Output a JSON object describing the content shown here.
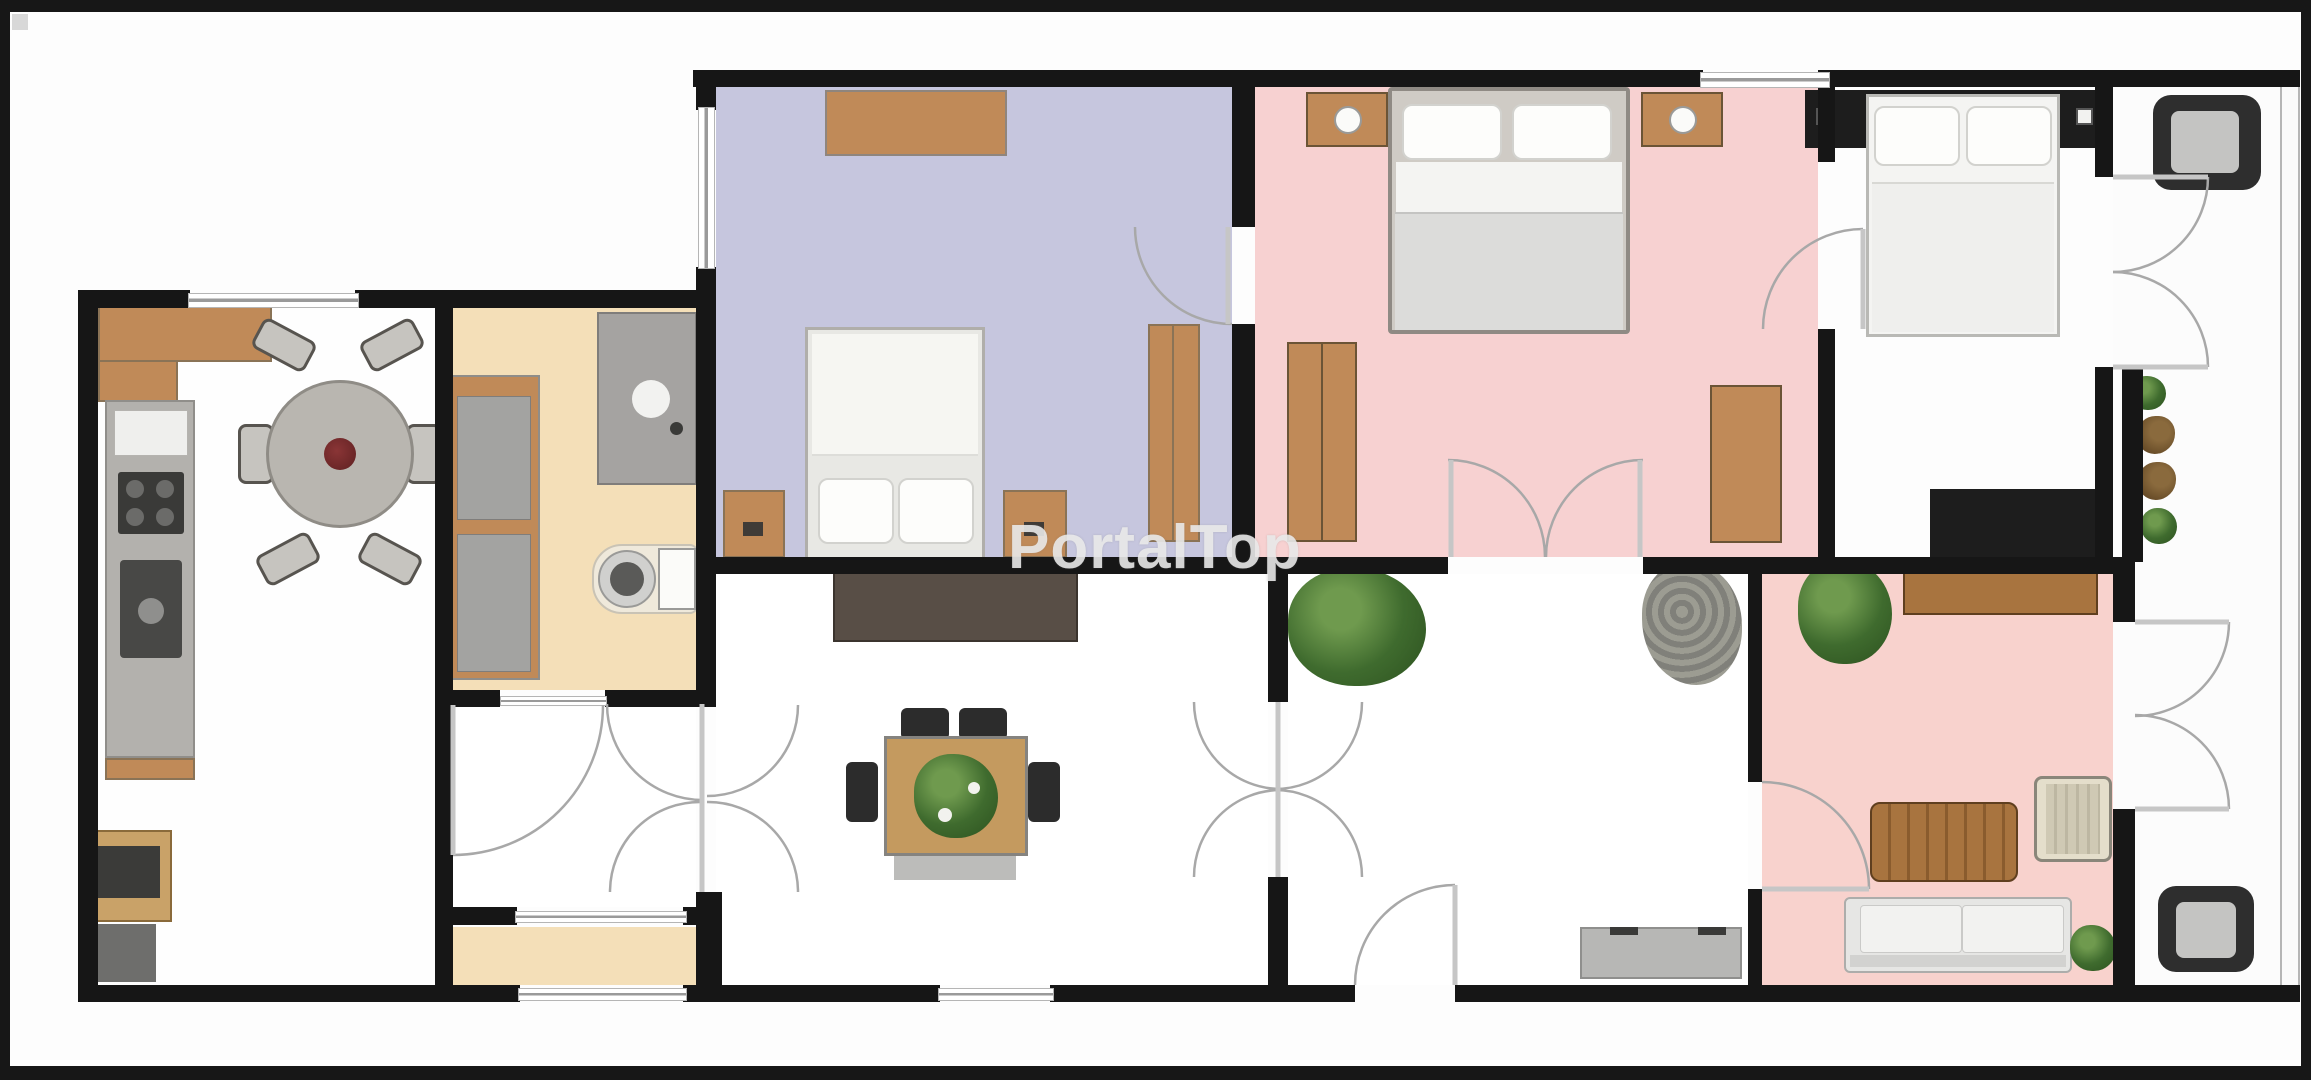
{
  "watermark": {
    "text": "PortalTop"
  },
  "palette": {
    "wall": "#161616",
    "frame": "#171717",
    "window_line": "#9a9a9a",
    "door_arc": "#a8a8a8",
    "floor_white": "#ffffff",
    "floor_lavender": "#c6c6de",
    "floor_pink_bedroom": "#f7d1d1",
    "floor_pink_living": "#f8d2cd",
    "floor_cream": "#f4dfb8",
    "wood_light": "#c08a58",
    "wood_dark": "#a8743f",
    "counter_gray": "#b3b1ad",
    "sideboard_brown": "#584e46",
    "chair_black": "#2c2c2c",
    "rug_gray": "#bcbcba",
    "sofa_gray": "#e6e6e4",
    "plant_green": "#3f6b2e",
    "shrub_gray": "#8d8d83",
    "watermark_gray": "rgba(236,236,236,0.88)"
  },
  "rooms": [
    {
      "id": "kitchen-dining",
      "style": "background:#fefefe"
    },
    {
      "id": "bathroom",
      "style": "background:#f4dfb8"
    },
    {
      "id": "hallway-left",
      "style": "background:#ffffff"
    },
    {
      "id": "vestibule",
      "style": "background:#f4dfb8"
    },
    {
      "id": "bedroom-lavender",
      "style": "background:#c6c6de"
    },
    {
      "id": "bedroom-pink",
      "style": "background:#f7d1d1"
    },
    {
      "id": "bedroom-white",
      "style": "background:#fdfdfd"
    },
    {
      "id": "living-central",
      "style": "background:#ffffff"
    },
    {
      "id": "hall-right",
      "style": "background:#ffffff"
    },
    {
      "id": "living-pink",
      "style": "background:#f8d2cd"
    },
    {
      "id": "balcony",
      "style": "background:#fcfcfc"
    }
  ],
  "furniture": [
    "kitchen-counter",
    "kitchen-oven",
    "round-dining-table",
    "dining-chairs-6",
    "bath-cabinet",
    "shower",
    "toilet",
    "dresser",
    "double-bed-lavender",
    "nightstands-lavender",
    "wardrobe-lavender",
    "double-bed-pink",
    "nightstands-with-lamps",
    "wardrobes-pink",
    "headboard-unit-black",
    "double-bed-white",
    "desk-black",
    "sideboard-dark",
    "square-dining-table",
    "dining-chairs-black",
    "rug",
    "plants",
    "gray-shrub",
    "bench",
    "sideboard-wood",
    "coffee-table",
    "striped-armchair",
    "sofa",
    "balcony-armchairs",
    "balcony-plants"
  ]
}
